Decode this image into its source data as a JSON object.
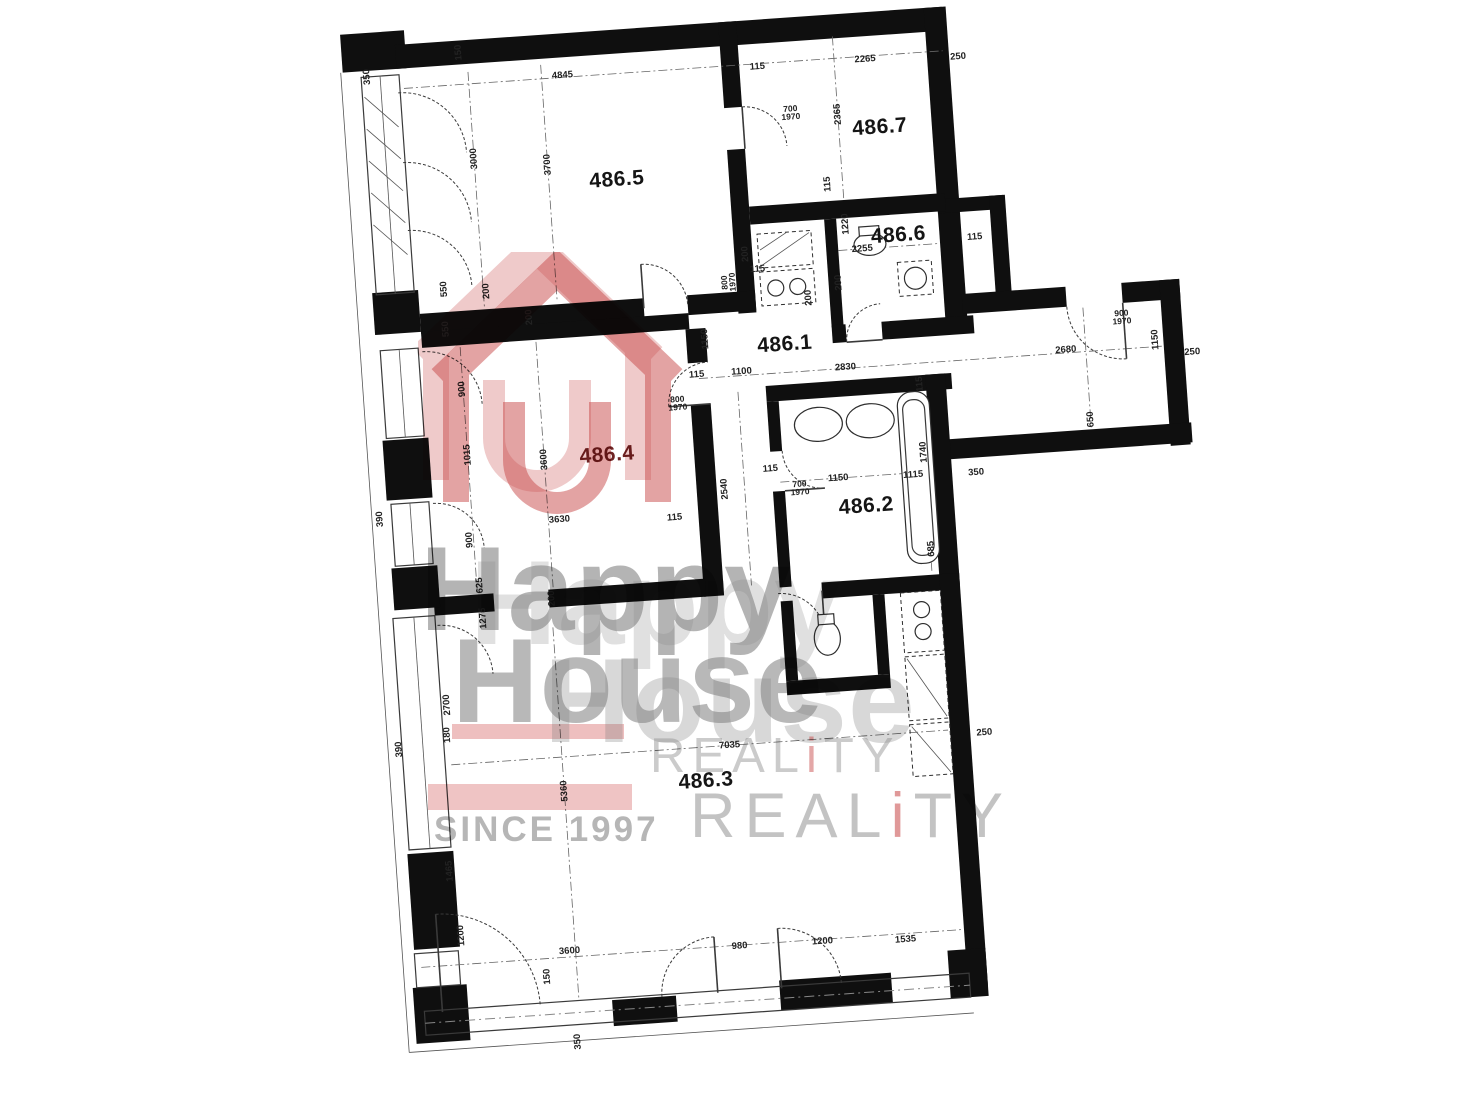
{
  "document": {
    "kind": "scanned apartment floor plan",
    "wall_color": "#0f0f0f",
    "paper_color": "#ffffff"
  },
  "plan": {
    "unit_labels": [
      {
        "id": "486.5",
        "x": 312,
        "y": 180,
        "color": "#151515"
      },
      {
        "id": "486.7",
        "x": 578,
        "y": 146,
        "color": "#151515"
      },
      {
        "id": "486.6",
        "x": 589,
        "y": 255,
        "color": "#151515"
      },
      {
        "id": "486.1",
        "x": 468,
        "y": 356,
        "color": "#151515"
      },
      {
        "id": "486.4",
        "x": 283,
        "y": 454,
        "color": "#6e2222"
      },
      {
        "id": "486.2",
        "x": 538,
        "y": 523,
        "color": "#151515"
      },
      {
        "id": "486.3",
        "x": 359,
        "y": 786,
        "color": "#151515"
      }
    ],
    "dimensions_mm": [
      {
        "t": "350",
        "x": 70,
        "y": 60,
        "r": -90
      },
      {
        "t": "150",
        "x": 163,
        "y": 42,
        "r": -90
      },
      {
        "t": "4845",
        "x": 265,
        "y": 72,
        "r": 0
      },
      {
        "t": "115",
        "x": 460,
        "y": 77,
        "r": 0
      },
      {
        "t": "2265",
        "x": 568,
        "y": 77,
        "r": 0
      },
      {
        "t": "250",
        "x": 661,
        "y": 81,
        "r": 0
      },
      {
        "t": "3000",
        "x": 171,
        "y": 149,
        "r": -90
      },
      {
        "t": "3700",
        "x": 244,
        "y": 160,
        "r": -90
      },
      {
        "t": "550",
        "x": 132,
        "y": 277,
        "r": -90
      },
      {
        "t": "200",
        "x": 174,
        "y": 282,
        "r": -90
      },
      {
        "t": "700\n1970",
        "x": 490,
        "y": 125,
        "r": 0
      },
      {
        "t": "2365",
        "x": 537,
        "y": 130,
        "r": -90
      },
      {
        "t": "115",
        "x": 522,
        "y": 199,
        "r": -90
      },
      {
        "t": "1220",
        "x": 537,
        "y": 240,
        "r": -90
      },
      {
        "t": "2255",
        "x": 552,
        "y": 266,
        "r": 0
      },
      {
        "t": "200",
        "x": 526,
        "y": 298,
        "r": -90
      },
      {
        "t": "115",
        "x": 665,
        "y": 262,
        "r": 0
      },
      {
        "t": "800\n1970",
        "x": 416,
        "y": 290,
        "r": -90
      },
      {
        "t": "115",
        "x": 446,
        "y": 279,
        "r": 0
      },
      {
        "t": "200",
        "x": 435,
        "y": 263,
        "r": -90
      },
      {
        "t": "1150",
        "x": 389,
        "y": 345,
        "r": -90
      },
      {
        "t": "115",
        "x": 378,
        "y": 380,
        "r": 0
      },
      {
        "t": "1100",
        "x": 423,
        "y": 380,
        "r": 0
      },
      {
        "t": "2830",
        "x": 527,
        "y": 383,
        "r": 0
      },
      {
        "t": "115",
        "x": 600,
        "y": 405,
        "r": -90
      },
      {
        "t": "2680",
        "x": 748,
        "y": 381,
        "r": 0
      },
      {
        "t": "1150",
        "x": 838,
        "y": 377,
        "r": -90
      },
      {
        "t": "900\n1970",
        "x": 806,
        "y": 352,
        "r": 0
      },
      {
        "t": "250",
        "x": 874,
        "y": 392,
        "r": 0
      },
      {
        "t": "650",
        "x": 768,
        "y": 452,
        "r": -90
      },
      {
        "t": "550",
        "x": 131,
        "y": 317,
        "r": -90
      },
      {
        "t": "200",
        "x": 215,
        "y": 311,
        "r": -90
      },
      {
        "t": "200",
        "x": 495,
        "y": 311,
        "r": -90
      },
      {
        "t": "900",
        "x": 143,
        "y": 378,
        "r": -90
      },
      {
        "t": "1015",
        "x": 144,
        "y": 444,
        "r": -90
      },
      {
        "t": "900",
        "x": 140,
        "y": 529,
        "r": -90
      },
      {
        "t": "625",
        "x": 147,
        "y": 575,
        "r": -90
      },
      {
        "t": "3600",
        "x": 220,
        "y": 454,
        "r": -90
      },
      {
        "t": "3630",
        "x": 231,
        "y": 515,
        "r": 0
      },
      {
        "t": "115",
        "x": 346,
        "y": 521,
        "r": 0
      },
      {
        "t": "800\n1970",
        "x": 357,
        "y": 407,
        "r": 0
      },
      {
        "t": "2540",
        "x": 398,
        "y": 496,
        "r": -90
      },
      {
        "t": "1150",
        "x": 512,
        "y": 493,
        "r": 0
      },
      {
        "t": "1115",
        "x": 587,
        "y": 495,
        "r": 0
      },
      {
        "t": "1740",
        "x": 599,
        "y": 473,
        "r": -90
      },
      {
        "t": "700\n1970",
        "x": 473,
        "y": 500,
        "r": 0
      },
      {
        "t": "115",
        "x": 445,
        "y": 479,
        "r": 0
      },
      {
        "t": "685",
        "x": 600,
        "y": 570,
        "r": -90
      },
      {
        "t": "350",
        "x": 650,
        "y": 497,
        "r": 0
      },
      {
        "t": "200",
        "x": 218,
        "y": 593,
        "r": -90
      },
      {
        "t": "7035",
        "x": 385,
        "y": 752,
        "r": 0
      },
      {
        "t": "250",
        "x": 640,
        "y": 757,
        "r": 0
      },
      {
        "t": "5360",
        "x": 217,
        "y": 786,
        "r": -90
      },
      {
        "t": "2700",
        "x": 106,
        "y": 692,
        "r": -90
      },
      {
        "t": "1275",
        "x": 148,
        "y": 608,
        "r": -90
      },
      {
        "t": "180",
        "x": 104,
        "y": 722,
        "r": -90
      },
      {
        "t": "390",
        "x": 52,
        "y": 502,
        "r": -90
      },
      {
        "t": "390",
        "x": 55,
        "y": 733,
        "r": -90
      },
      {
        "t": "1465",
        "x": 97,
        "y": 858,
        "r": -90
      },
      {
        "t": "1200",
        "x": 104,
        "y": 923,
        "r": -90
      },
      {
        "t": "3600",
        "x": 211,
        "y": 946,
        "r": 0
      },
      {
        "t": "150",
        "x": 187,
        "y": 970,
        "r": -90
      },
      {
        "t": "980",
        "x": 381,
        "y": 953,
        "r": 0
      },
      {
        "t": "1200",
        "x": 464,
        "y": 954,
        "r": 0
      },
      {
        "t": "1535",
        "x": 547,
        "y": 958,
        "r": 0
      },
      {
        "t": "350",
        "x": 213,
        "y": 1037,
        "r": -90
      }
    ]
  },
  "watermark": {
    "happy": "Happy",
    "house": "House",
    "reality": {
      "pre": "REAL",
      "i": "i",
      "post": "TY"
    },
    "since": "SINCE 1997",
    "brand_red": "#c94f4f",
    "brand_gray": "#8e8e8e"
  }
}
